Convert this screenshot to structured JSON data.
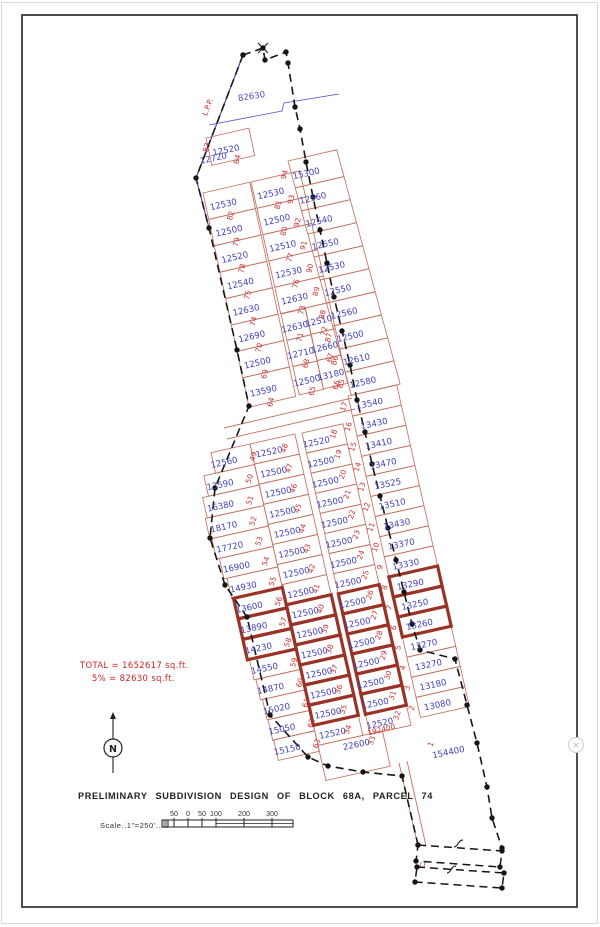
{
  "annotations": {
    "title": "PRELIMINARY SUBDIVISION DESIGN OF BLOCK 68A, PARCEL 74",
    "total1": "TOTAL = 1652617 sq.ft.",
    "total2": "5% = 82630 sq.ft.",
    "scale_label": "Scale..1\"=250'.....",
    "north_label": "N"
  },
  "ui": {
    "toggle_glyph": "×"
  },
  "colors": {
    "lot_line": "#c4705f",
    "bold_line": "#9a3226",
    "value_text": "#4040c0",
    "number_text": "#cc3030",
    "boundary": "#161616",
    "purple_edge": "#4433aa",
    "dim_blue": "#5050c8",
    "annotation_red": "#cc2222",
    "border_dark": "#3a3a3a",
    "page_edge": "#d8d8d8"
  },
  "scalebar": {
    "x0": 168,
    "x1": 293,
    "y0": 820,
    "y1": 827,
    "midline_from": 216,
    "ticks": [
      {
        "x": 174,
        "label": "50"
      },
      {
        "x": 188,
        "label": "0"
      },
      {
        "x": 202,
        "label": "50"
      },
      {
        "x": 216,
        "label": "100"
      },
      {
        "x": 244,
        "label": "200"
      },
      {
        "x": 272,
        "label": "300"
      }
    ]
  },
  "north": {
    "cx": 113,
    "cy": 748,
    "r": 9,
    "top": 719,
    "bottom": 773
  },
  "toggle": {
    "cx": 576,
    "cy": 745,
    "r": 7.5
  },
  "map": {
    "columns": [
      {
        "id": "u-top",
        "o": [
          206,
          138
        ],
        "r": [
          0.974,
          -0.225
        ],
        "d": [
          0.21,
          0.978
        ],
        "w": 44,
        "h": 28,
        "va": 0.4,
        "vr": -12,
        "nr": -76,
        "no": [
          13,
          10
        ],
        "lots": [
          {
            "n": "84",
            "v": "12520"
          }
        ]
      },
      {
        "id": "u-left",
        "o": [
          203,
          193
        ],
        "r": [
          0.974,
          -0.225
        ],
        "d": [
          0.21,
          0.978
        ],
        "w": 48,
        "h": 27,
        "va": 0.38,
        "vr": -13,
        "nr": -76,
        "no": [
          9,
          12
        ],
        "lots": [
          {
            "n": "82",
            "v": "12530"
          },
          {
            "n": "79",
            "v": "12500"
          },
          {
            "n": "78",
            "v": "12520"
          },
          {
            "n": "75",
            "v": "12540"
          },
          {
            "n": "74",
            "v": "12630"
          },
          {
            "n": "70",
            "v": "12690"
          },
          {
            "n": "69",
            "v": "12500"
          },
          {
            "n": "64",
            "v": "13590",
            "h": 30
          }
        ]
      },
      {
        "id": "u-mid",
        "o": [
          251,
          182
        ],
        "r": [
          0.974,
          -0.225
        ],
        "d": [
          0.22,
          0.975
        ],
        "w": 50,
        "h": 27,
        "va": 0.35,
        "vr": -13,
        "nr": -76,
        "no": [
          9,
          12
        ],
        "lots": [
          {
            "n": "81",
            "v": "12530"
          },
          {
            "n": "80",
            "v": "12500"
          },
          {
            "n": "77",
            "v": "12510"
          },
          {
            "n": "76",
            "v": "12530"
          },
          {
            "n": "73",
            "v": "12630"
          }
        ]
      },
      {
        "id": "u-mid-a",
        "o": [
          281,
          314
        ],
        "r": [
          0.974,
          -0.225
        ],
        "d": [
          0.22,
          0.975
        ],
        "w": 25,
        "h": 27,
        "va": 0.45,
        "vr": -13,
        "nr": -76,
        "no": [
          7,
          11
        ],
        "lots": [
          {
            "n": "71",
            "v": "12630"
          },
          {
            "n": "68",
            "v": "12710"
          },
          {
            "n": "65",
            "v": "12500",
            "h": 29
          }
        ]
      },
      {
        "id": "u-mid-b",
        "o": [
          305,
          308
        ],
        "r": [
          0.974,
          -0.225
        ],
        "d": [
          0.22,
          0.975
        ],
        "w": 25,
        "h": 27,
        "va": 0.45,
        "vr": -13,
        "nr": -76,
        "no": [
          7,
          11
        ],
        "lots": [
          {
            "n": "72",
            "v": "12510"
          },
          {
            "n": "67",
            "v": "12660"
          },
          {
            "n": "66",
            "v": "13180",
            "h": 29
          }
        ]
      },
      {
        "id": "u-right",
        "o": [
          288,
          161
        ],
        "r": [
          0.974,
          -0.225
        ],
        "d": [
          0.26,
          0.96
        ],
        "w": 50,
        "h": 24,
        "va": 0.3,
        "vr": -13,
        "nr": -76,
        "no": [
          -20,
          2
        ],
        "lots": [
          {
            "n": "94",
            "v": "15300",
            "h": 28
          },
          {
            "n": "93",
            "v": "12560"
          },
          {
            "n": "92",
            "v": "12540"
          },
          {
            "n": "91",
            "v": "12550"
          },
          {
            "n": "90",
            "v": "12530"
          },
          {
            "n": "89",
            "v": "12550"
          },
          {
            "n": "88",
            "v": "12560"
          },
          {
            "n": "87",
            "v": "12500"
          },
          {
            "n": "86",
            "v": "12610"
          },
          {
            "n": "85",
            "v": "12580"
          }
        ]
      },
      {
        "id": "l-farleft",
        "o": [
          250,
          444
        ],
        "r": [
          0.976,
          -0.218
        ],
        "d": [
          0.22,
          0.9755
        ],
        "w": -42,
        "h": 21,
        "va": 0.72,
        "vr": -12,
        "nr": -72,
        "no": [
          31,
          -5
        ],
        "lots": [
          {
            "n": "49",
            "v": "12560",
            "w": -40
          },
          {
            "n": "50",
            "v": "13590",
            "w": -52
          },
          {
            "n": "51",
            "v": "16380",
            "w": -58
          },
          {
            "n": "52",
            "v": "18170",
            "w": -60
          },
          {
            "n": "53",
            "v": "17720",
            "w": -58
          },
          {
            "n": "54",
            "v": "16900",
            "w": -55
          },
          {
            "n": "55",
            "v": "14930",
            "w": -52
          },
          {
            "n": "56",
            "v": "13600",
            "w": -50,
            "b": 1
          },
          {
            "n": "57",
            "v": "13890",
            "w": -50,
            "b": 1
          },
          {
            "n": "58",
            "v": "14230",
            "w": -50,
            "b": 1
          },
          {
            "n": "59",
            "v": "14550",
            "w": -48
          },
          {
            "n": "60",
            "v": "14870",
            "w": -46
          },
          {
            "n": "61",
            "v": "15020",
            "w": -44
          },
          {
            "n": "62",
            "v": "15050",
            "w": -43
          },
          {
            "n": "63",
            "v": "15150",
            "w": -42
          }
        ]
      },
      {
        "id": "l-col2",
        "o": [
          250,
          444
        ],
        "r": [
          0.976,
          -0.218
        ],
        "d": [
          0.22,
          0.9755
        ],
        "w": 46,
        "h": 20.6,
        "va": 0.38,
        "vr": -12,
        "nr": -72,
        "no": [
          17,
          -3
        ],
        "lots": [
          {
            "n": "48",
            "v": "12520"
          },
          {
            "n": "47",
            "v": "12500"
          },
          {
            "n": "46",
            "v": "12500"
          },
          {
            "n": "45",
            "v": "12500"
          },
          {
            "n": "44",
            "v": "12500"
          },
          {
            "n": "43",
            "v": "12500"
          },
          {
            "n": "42",
            "v": "12500"
          },
          {
            "n": "41",
            "v": "12500"
          },
          {
            "n": "40",
            "v": "12500",
            "b": 1
          },
          {
            "n": "39",
            "v": "12500",
            "b": 1
          },
          {
            "n": "38",
            "v": "12500",
            "b": 1
          },
          {
            "n": "37",
            "v": "12500",
            "b": 1
          },
          {
            "n": "36",
            "v": "12500",
            "b": 1
          },
          {
            "n": "35",
            "v": "12500",
            "b": 1
          },
          {
            "n": "34",
            "v": "12520"
          },
          {
            "n": "33",
            "v": "22600",
            "h": 36,
            "w": 66,
            "vo": [
              10,
              -16
            ]
          }
        ]
      },
      {
        "id": "l-col3",
        "o": [
          302,
          433
        ],
        "r": [
          0.976,
          -0.218
        ],
        "d": [
          0.22,
          0.9755
        ],
        "w": 42,
        "h": 20.6,
        "va": 0.3,
        "vr": -12,
        "nr": -72,
        "no": [
          19,
          -7
        ],
        "lots": [
          {
            "n": "18",
            "v": "12520"
          },
          {
            "n": "19",
            "v": "12500"
          },
          {
            "n": "20",
            "v": "12500"
          },
          {
            "n": "21",
            "v": "12500"
          },
          {
            "n": "22",
            "v": "12500"
          },
          {
            "n": "23",
            "v": "12500"
          },
          {
            "n": "24",
            "v": "12500"
          },
          {
            "n": "25",
            "v": "12500"
          },
          {
            "n": "26",
            "v": "12500",
            "b": 1
          },
          {
            "n": "27",
            "v": "12500",
            "b": 1
          },
          {
            "n": "28",
            "v": "12500",
            "b": 1
          },
          {
            "n": "29",
            "v": "12500",
            "b": 1
          },
          {
            "n": "30",
            "v": "12500",
            "b": 1
          },
          {
            "n": "31",
            "v": "12500",
            "b": 1
          },
          {
            "n": "32",
            "v": "12520"
          }
        ]
      },
      {
        "id": "l-col4",
        "o": [
          348,
          396
        ],
        "r": [
          0.976,
          -0.218
        ],
        "d": [
          0.22,
          0.9755
        ],
        "w": 50,
        "h": 20.6,
        "va": 0.4,
        "vr": -12,
        "nr": -72,
        "no": [
          -24,
          4
        ],
        "lots": [
          {
            "n": "17",
            "v": "13540"
          },
          {
            "n": "16",
            "v": "13430"
          },
          {
            "n": "15",
            "v": "13410"
          },
          {
            "n": "14",
            "v": "13470"
          },
          {
            "n": "13",
            "v": "13525"
          },
          {
            "n": "12",
            "v": "13510"
          },
          {
            "n": "11",
            "v": "13430"
          },
          {
            "n": "10",
            "v": "13370"
          },
          {
            "n": "9",
            "v": "13330"
          },
          {
            "n": "8",
            "v": "13290",
            "b": 1
          },
          {
            "n": "7",
            "v": "13250",
            "b": 1
          },
          {
            "n": "6",
            "v": "13260",
            "b": 1
          },
          {
            "n": "5",
            "v": "13270"
          },
          {
            "n": "4",
            "v": "13270"
          },
          {
            "n": "3",
            "v": "13180"
          },
          {
            "n": "2",
            "v": "13080"
          }
        ]
      }
    ],
    "boundary_left": [
      [
        243,
        55
      ],
      [
        196,
        178
      ],
      [
        209,
        228
      ],
      [
        237,
        350
      ],
      [
        249,
        406
      ],
      [
        215,
        488
      ],
      [
        210,
        538
      ],
      [
        225,
        585
      ],
      [
        247,
        617
      ],
      [
        270,
        715
      ],
      [
        308,
        757
      ],
      [
        328,
        766
      ],
      [
        363,
        772
      ],
      [
        402,
        776
      ],
      [
        418,
        845
      ]
    ],
    "boundary_right": [
      [
        243,
        55
      ],
      [
        263,
        48
      ],
      [
        265,
        60
      ],
      [
        286,
        52
      ],
      [
        288,
        63
      ],
      [
        295,
        107
      ],
      [
        300,
        129
      ],
      [
        306,
        162
      ],
      [
        313,
        197
      ],
      [
        320,
        230
      ],
      [
        327,
        263
      ],
      [
        334,
        297
      ],
      [
        342,
        331
      ],
      [
        350,
        365
      ],
      [
        357,
        400
      ],
      [
        365,
        432
      ],
      [
        372,
        464
      ],
      [
        380,
        496
      ],
      [
        388,
        528
      ],
      [
        396,
        560
      ],
      [
        404,
        592
      ],
      [
        412,
        624
      ],
      [
        420,
        650
      ],
      [
        455,
        659
      ],
      [
        467,
        705
      ],
      [
        477,
        743
      ],
      [
        487,
        787
      ],
      [
        492,
        818
      ],
      [
        502,
        848
      ]
    ],
    "purple_segments": [
      [
        [
          243,
          55
        ],
        [
          196,
          178
        ]
      ],
      [
        [
          196,
          178
        ],
        [
          209,
          228
        ]
      ]
    ],
    "detached": [
      [
        [
          418,
          845
        ],
        [
          502,
          851
        ],
        [
          500,
          867
        ],
        [
          416,
          861
        ]
      ],
      [
        [
          417,
          867
        ],
        [
          504,
          873
        ],
        [
          502,
          888
        ],
        [
          415,
          882
        ]
      ]
    ],
    "squiggles": [
      [
        459,
        845
      ],
      [
        452,
        871
      ]
    ],
    "xmark": [
      263,
      48
    ],
    "roads": [
      [
        [
          224,
          428
        ],
        [
          352,
          398
        ]
      ],
      [
        [
          227,
          439
        ],
        [
          355,
          409
        ]
      ],
      [
        [
          399,
          763
        ],
        [
          418,
          846
        ]
      ],
      [
        [
          407,
          761
        ],
        [
          426,
          846
        ]
      ],
      [
        [
          421,
          862
        ],
        [
          420,
          867
        ]
      ],
      [
        [
          425,
          862
        ],
        [
          424,
          867
        ]
      ]
    ],
    "dim_line": [
      [
        209,
        125
      ],
      [
        282,
        111
      ],
      [
        284,
        103
      ],
      [
        339,
        94
      ]
    ],
    "labels": [
      {
        "t": "82630",
        "x": 252,
        "y": 99,
        "rot": -9,
        "c": "dim",
        "s": 8.8
      },
      {
        "t": "L.P.P.",
        "x": 210,
        "y": 108,
        "rot": -69,
        "c": "num",
        "s": 8
      },
      {
        "t": "12720",
        "x": 214,
        "y": 161,
        "rot": -12,
        "c": "val",
        "s": 8.6
      },
      {
        "t": "83",
        "x": 209,
        "y": 148,
        "rot": -76,
        "c": "num",
        "s": 7.4
      },
      {
        "t": "154400",
        "x": 449,
        "y": 755,
        "rot": -12,
        "c": "val",
        "s": 9.5
      },
      {
        "t": "1",
        "x": 433,
        "y": 745,
        "rot": -70,
        "c": "num",
        "s": 7.4
      },
      {
        "t": "192400",
        "x": 382,
        "y": 732,
        "rot": -14,
        "c": "num",
        "s": 8.5
      }
    ]
  }
}
